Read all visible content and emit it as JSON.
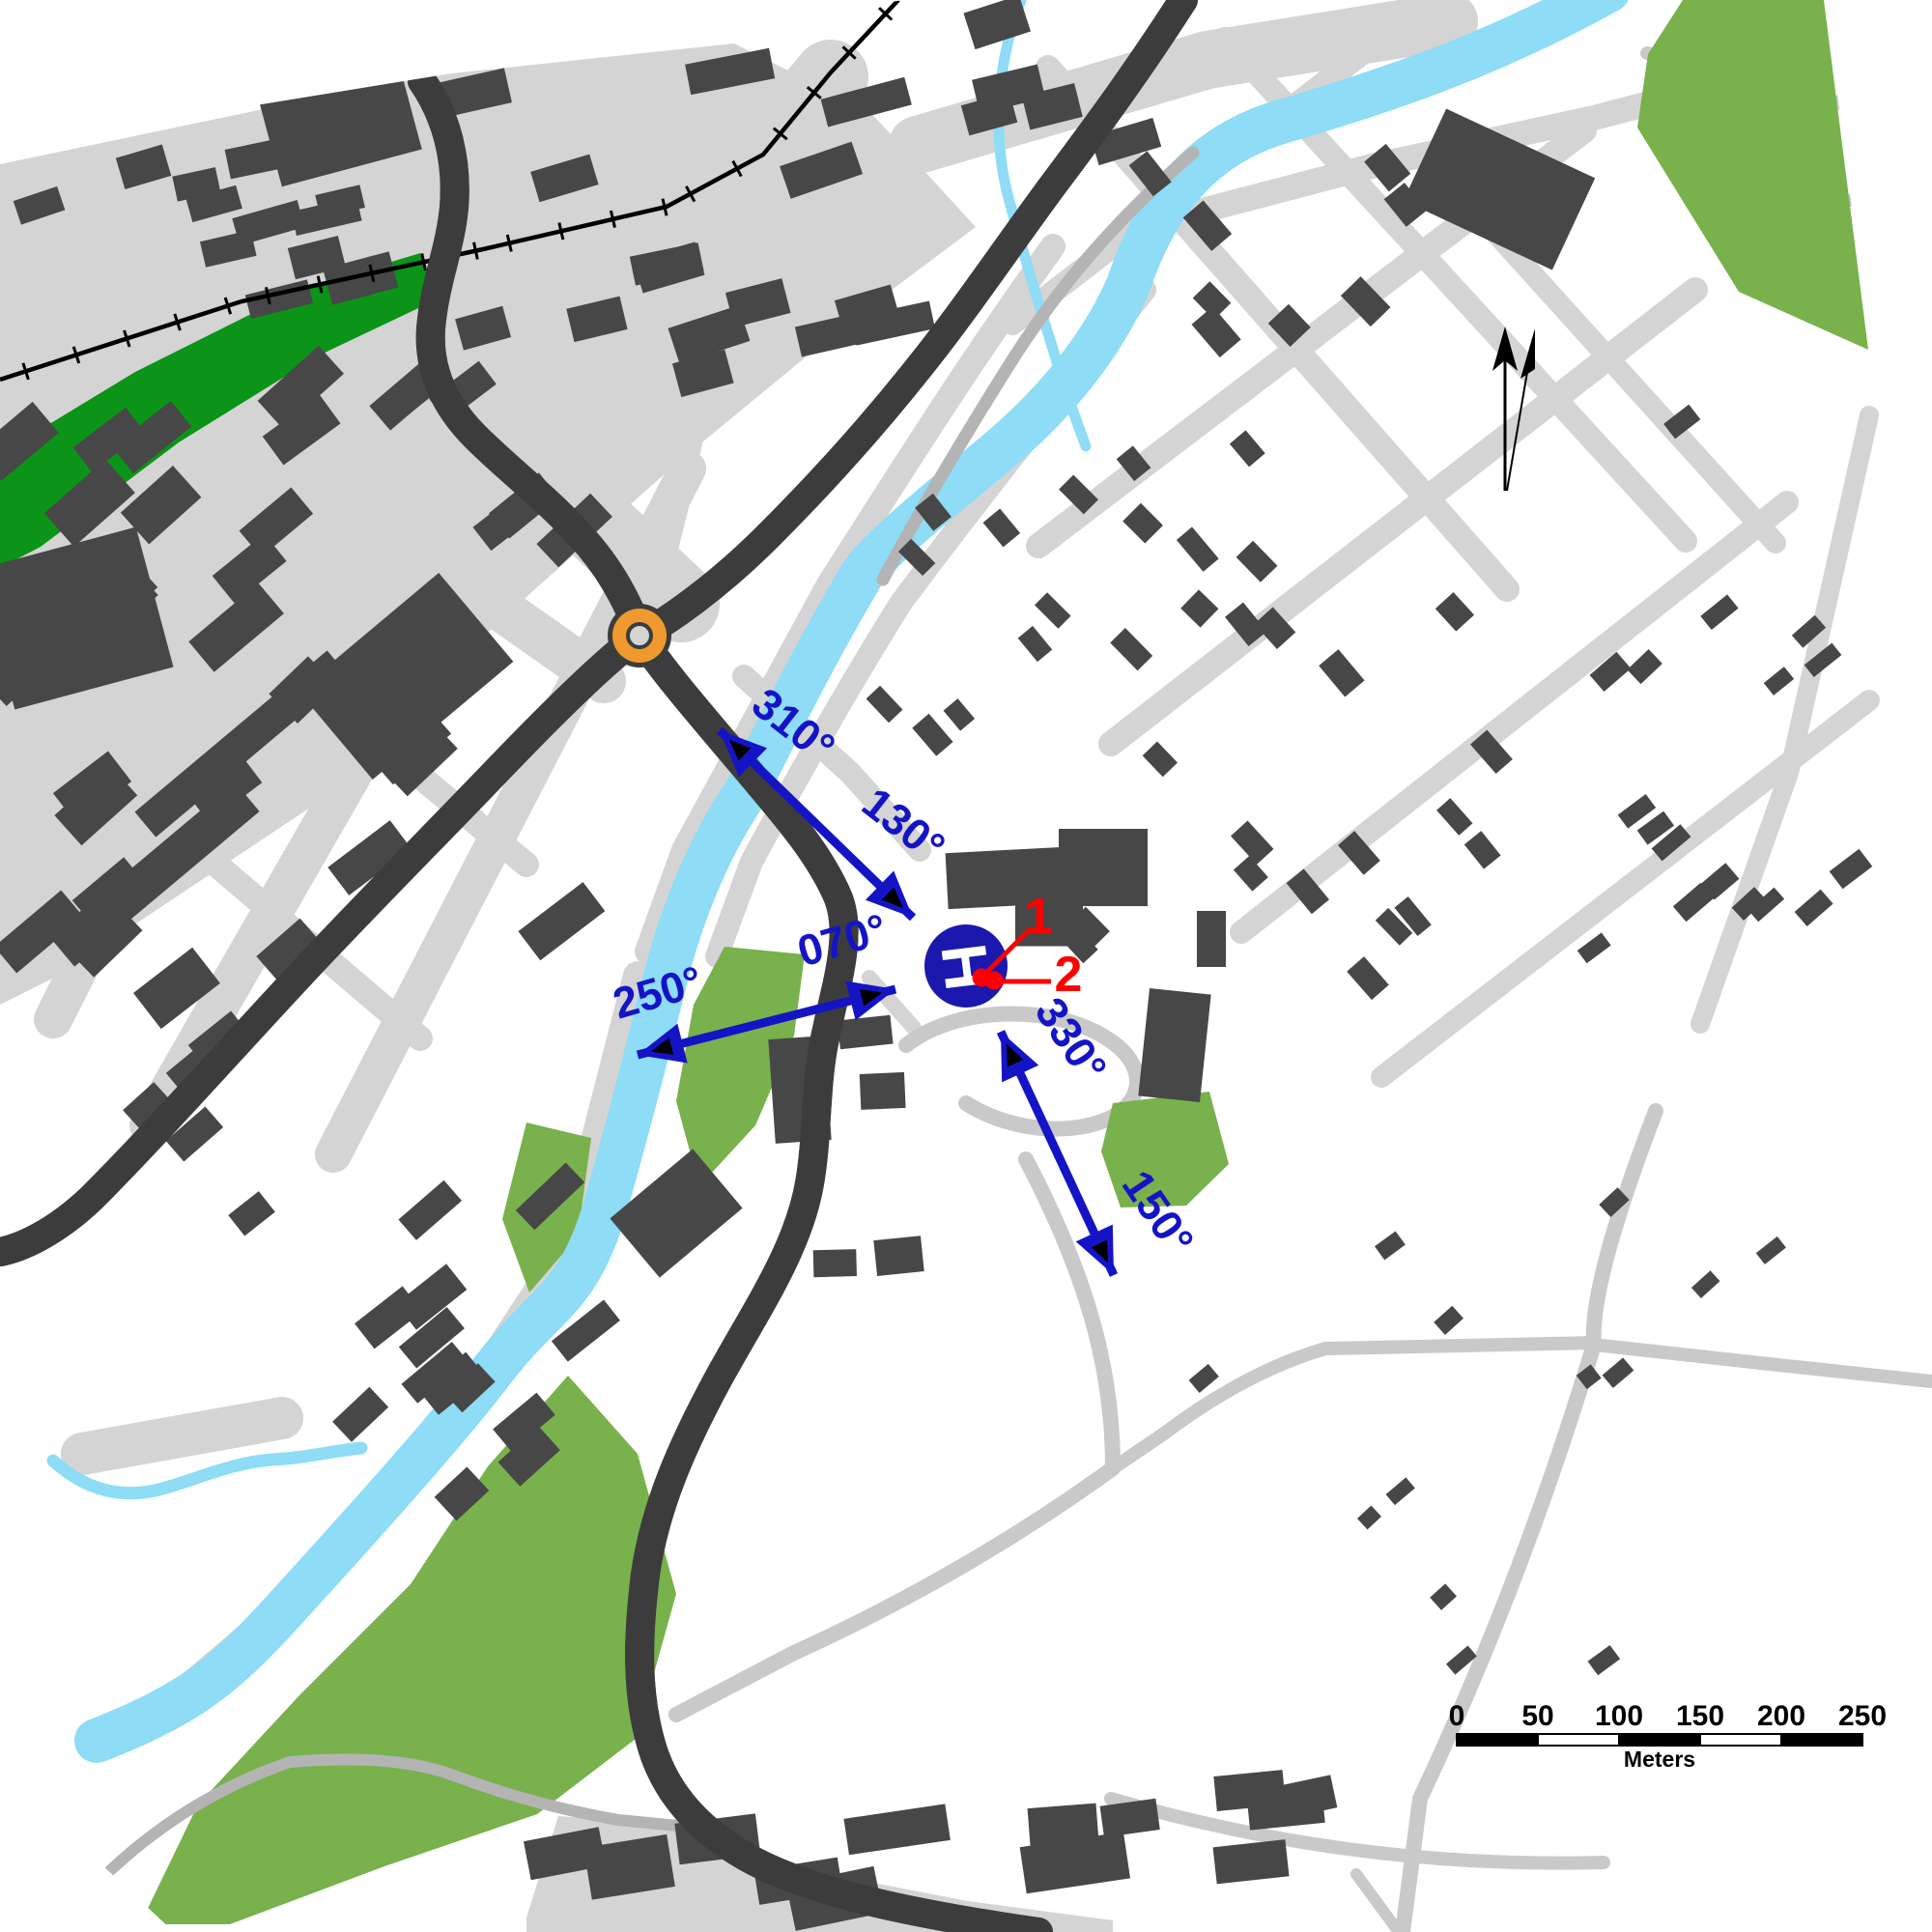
{
  "palette": {
    "bg": "#ffffff",
    "road": "#d4d4d4",
    "road_minor": "#c9c9c9",
    "path": "#b4b4b4",
    "building": "#474747",
    "railway": "#000000",
    "water": "#8edcf6",
    "orange": "#f0992e",
    "orange_casing": "#3c3c3c",
    "park": "#79b14d",
    "forest": "#0b9418",
    "annotation": "#1414c6",
    "helipad": "#1b18ad",
    "red": "#ff0000"
  },
  "bearings": [
    {
      "text": "310°",
      "degrees": 310
    },
    {
      "text": "130°",
      "degrees": 130
    },
    {
      "text": "250°",
      "degrees": 250
    },
    {
      "text": "070°",
      "degrees": 70
    },
    {
      "text": "330°",
      "degrees": 330
    },
    {
      "text": "150°",
      "degrees": 150
    }
  ],
  "helipad": {
    "symbol": "H"
  },
  "markers": [
    {
      "text": "1"
    },
    {
      "text": "2"
    }
  ],
  "scale_bar": {
    "tick_labels": [
      "0",
      "50",
      "100",
      "150",
      "200",
      "250"
    ],
    "unit": "Meters"
  }
}
